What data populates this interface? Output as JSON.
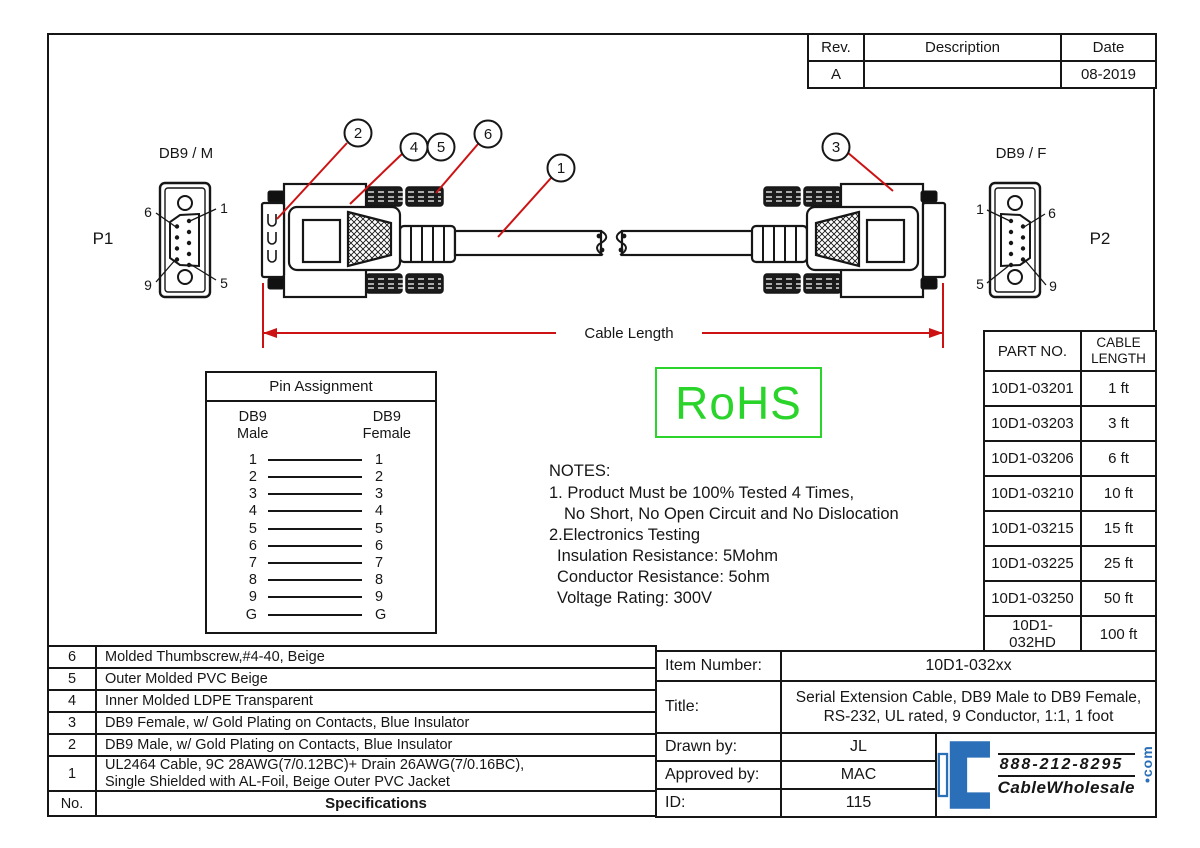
{
  "rev_table": {
    "headers": [
      "Rev.",
      "Description",
      "Date"
    ],
    "rows": [
      {
        "rev": "A",
        "description": "",
        "date": "08-2019"
      }
    ]
  },
  "connectors": {
    "left": {
      "title": "DB9 / M",
      "ref": "P1",
      "pins": {
        "tl": "6",
        "tr": "1",
        "bl": "9",
        "br": "5"
      }
    },
    "right": {
      "title": "DB9 / F",
      "ref": "P2",
      "pins": {
        "tl": "1",
        "tr": "6",
        "bl": "5",
        "br": "9"
      }
    }
  },
  "callouts": {
    "c1": "1",
    "c2": "2",
    "c3": "3",
    "c4": "4",
    "c5": "5",
    "c6": "6"
  },
  "dimension": {
    "label": "Cable Length"
  },
  "pin_assignment": {
    "title": "Pin Assignment",
    "left_header": "DB9\nMale",
    "right_header": "DB9\nFemale",
    "rows": [
      {
        "m": "1",
        "f": "1"
      },
      {
        "m": "2",
        "f": "2"
      },
      {
        "m": "3",
        "f": "3"
      },
      {
        "m": "4",
        "f": "4"
      },
      {
        "m": "5",
        "f": "5"
      },
      {
        "m": "6",
        "f": "6"
      },
      {
        "m": "7",
        "f": "7"
      },
      {
        "m": "8",
        "f": "8"
      },
      {
        "m": "9",
        "f": "9"
      },
      {
        "m": "G",
        "f": "G"
      }
    ]
  },
  "rohs": {
    "label": "RoHS",
    "color": "#2bd42b"
  },
  "notes": {
    "title": "NOTES:",
    "lines": [
      "1. Product Must be 100% Tested 4 Times,",
      "No Short, No Open Circuit and No Dislocation",
      "2.Electronics Testing",
      "Insulation Resistance: 5Mohm",
      "Conductor Resistance: 5ohm",
      "Voltage Rating: 300V"
    ]
  },
  "part_table": {
    "col_part": "PART NO.",
    "col_length": "CABLE\nLENGTH",
    "rows": [
      {
        "part": "10D1-03201",
        "length": "1 ft"
      },
      {
        "part": "10D1-03203",
        "length": "3 ft"
      },
      {
        "part": "10D1-03206",
        "length": "6 ft"
      },
      {
        "part": "10D1-03210",
        "length": "10 ft"
      },
      {
        "part": "10D1-03215",
        "length": "15 ft"
      },
      {
        "part": "10D1-03225",
        "length": "25 ft"
      },
      {
        "part": "10D1-03250",
        "length": "50 ft"
      },
      {
        "part": "10D1-032HD",
        "length": "100 ft"
      }
    ]
  },
  "spec_table": {
    "rows": [
      {
        "no": "6",
        "desc": "Molded Thumbscrew,#4-40, Beige"
      },
      {
        "no": "5",
        "desc": "Outer Molded PVC Beige"
      },
      {
        "no": "4",
        "desc": "Inner Molded LDPE Transparent"
      },
      {
        "no": "3",
        "desc": "DB9 Female, w/ Gold Plating on Contacts, Blue Insulator"
      },
      {
        "no": "2",
        "desc": "DB9 Male, w/ Gold Plating on Contacts, Blue Insulator"
      },
      {
        "no": "1",
        "desc": "UL2464 Cable, 9C 28AWG(7/0.12BC)+ Drain 26AWG(7/0.16BC),\nSingle Shielded with AL-Foil, Beige Outer PVC Jacket"
      }
    ],
    "footer_no": "No.",
    "footer_label": "Specifications"
  },
  "title_block": {
    "item_number_label": "Item Number:",
    "item_number": "10D1-032xx",
    "title_label": "Title:",
    "title_line1": "Serial Extension Cable, DB9 Male to DB9 Female,",
    "title_line2": "RS-232, UL rated, 9 Conductor, 1:1, 1 foot",
    "drawn_by_label": "Drawn by:",
    "drawn_by": "JL",
    "approved_by_label": "Approved by:",
    "approved_by": "MAC",
    "id_label": "ID:",
    "id": "115"
  },
  "logo": {
    "phone": "888-212-8295",
    "brand": "CableWholesale",
    "tld": "•com",
    "color": "#2a6fb7"
  }
}
